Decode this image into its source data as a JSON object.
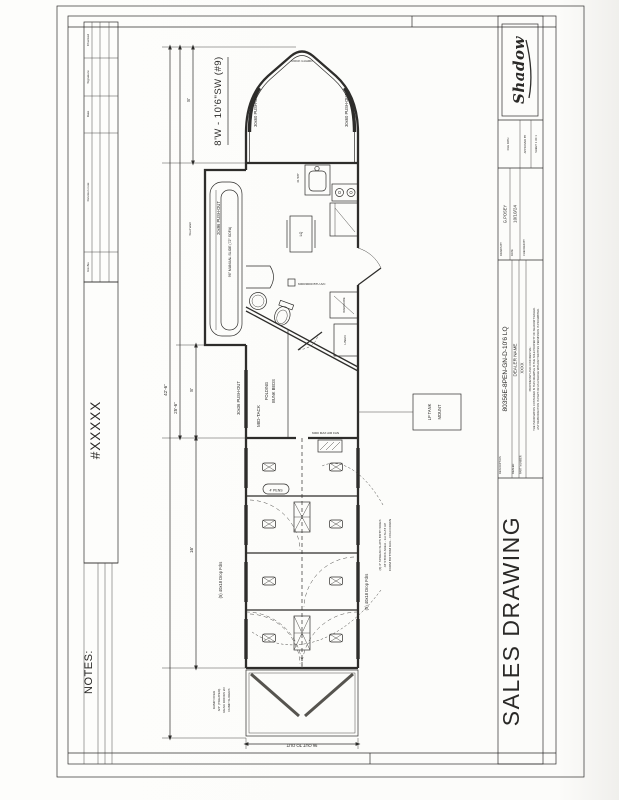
{
  "sheet": {
    "notes_label": "NOTES:",
    "sheet_number": "#XXXXX"
  },
  "revisions": {
    "col_checked": "Checked",
    "col_signature": "Signature",
    "col_date": "Date",
    "col_note": "Revision note",
    "col_revno": "RevNo"
  },
  "title_block": {
    "logo": "Shadow",
    "file_path_label": "FILE PATH",
    "approved_label": "APPROVED BY",
    "sheet_label": "SHEET: 1 OF 1",
    "drawn_label": "DRAWN BY",
    "drawn_by": "G.POSEY",
    "date_label": "DATE",
    "date": "10/10/24",
    "checked_label": "CHECKED BY",
    "description_label": "DESCRIPTION",
    "description": "80356E-8PEN-GN-D-10'6 LQ",
    "dealer_label": "DEALER",
    "dealer": "DEALER NAME",
    "part_label": "PART NUMBER",
    "part_number": "XXXX",
    "disclaimer_1": "PROPRIETARY AND CONFIDENTIAL:",
    "disclaimer_2": "THE INFORMATION CONTAINED IN THIS DRAWING IS THE SOLE PROPERTY OF SHADOW TRAILER.",
    "disclaimer_3": "ANY REPRODUCTION IN PART OR AS A WHOLE WITHOUT WRITTEN PERMISSION IS PROHIBITED.",
    "doc_type": "SALES DRAWING"
  },
  "plan": {
    "model_callout": "8'W - 10'6\"SW (#9)",
    "nose_peak_label": "ROCK GUARD",
    "nose_window_left": "30x60 PUSH-OUT",
    "nose_window_right": "30x60 PUSH-OUT",
    "dim_overall": "42'-6\"",
    "dim_front": "25'-6\"",
    "dim_nose": "8'",
    "dim_midtack": "8'",
    "dim_stock": "16'",
    "dim_rear_width": "96 OUT TO OUT",
    "stud_wall": "Stud Wall",
    "lq_slide": "20x96 PUSH-OUT",
    "lq_sofa": "96\" MANUAL SLIDE (72\" SOFA)",
    "lq_sink_dim": "41 5/8\"",
    "lq_table": "LQ",
    "lq_ac": "6000/9000 BTU A/C",
    "lq_wardrobe": "WARDROBE",
    "lq_linen": "LINEN",
    "midtack_label": "MID-TACK",
    "bunks_line1": "FOLDING",
    "bunks_line2": "BUNK BEDS",
    "midtack_window": "30x36 PUSH-OUT",
    "fan_label": "6000 MAX AIR FAN",
    "lp_line1": "LP TANK",
    "lp_line2": "MOUNT",
    "feeders_left": "(5) 40x18 Drop Fdrs",
    "feeders_right": "(5) 40x18 Drop Fdrs",
    "pens_tag": "4' PENS",
    "slat_note_1": "(2) 3\" SPREAD SLATS BOTH SIDES",
    "slat_note_2": "AT STOCK AREA - 1st SLAT UP",
    "slat_note_3": "FROM BOTTOM RAIL - FOLD DOWN",
    "ramp_note_1": "RAMP OVER",
    "ramp_note_2": "3/4\" (TREATED)",
    "ramp_note_3": "REAR DOORS W/",
    "ramp_note_4": "DUMP SLIDERS"
  }
}
